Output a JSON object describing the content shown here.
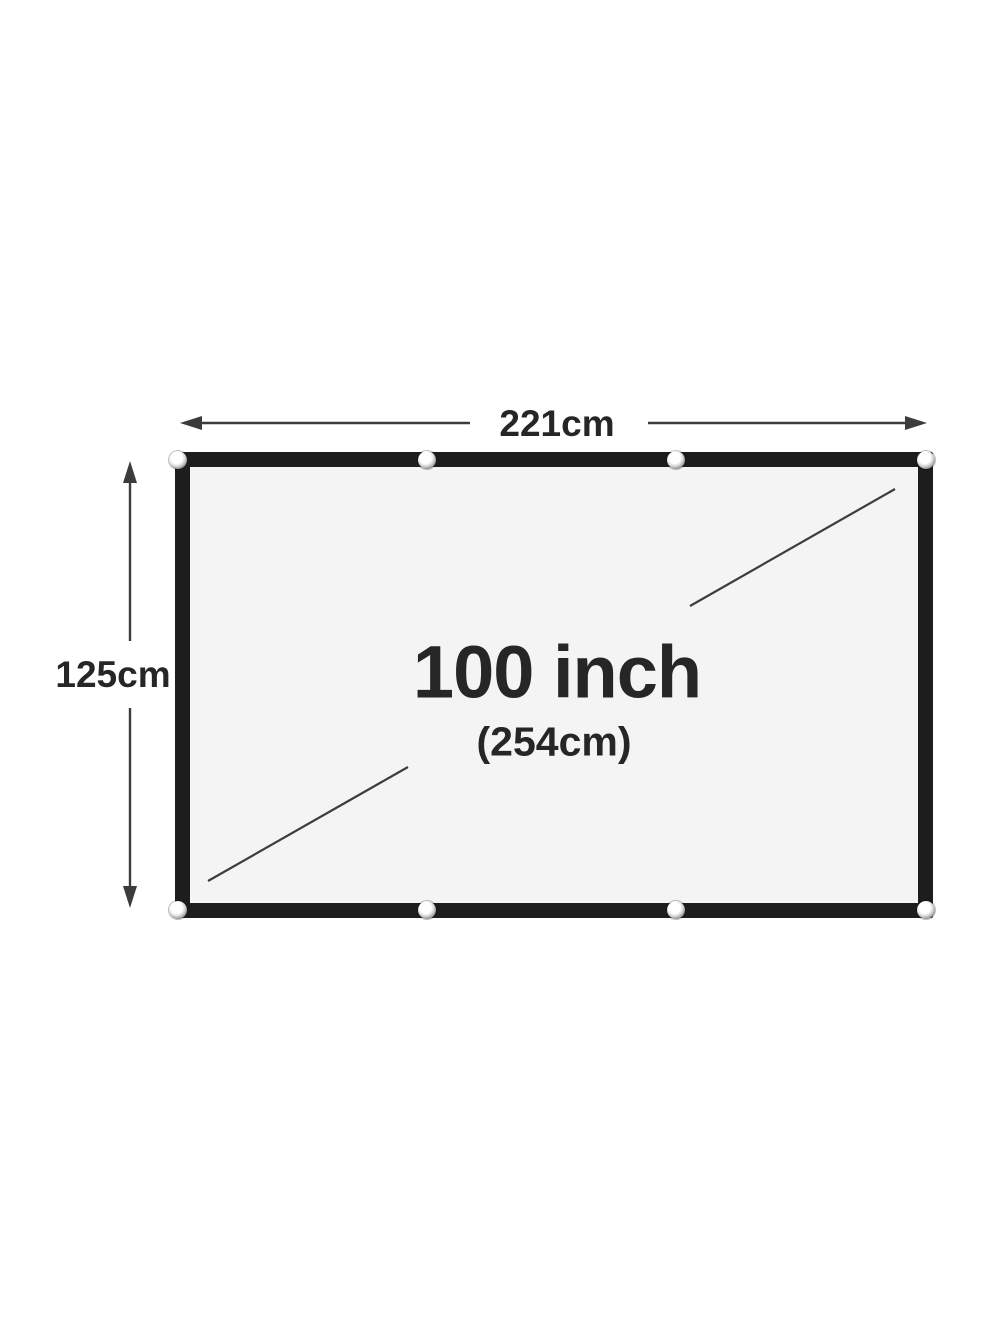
{
  "diagram": {
    "width_label": "221cm",
    "height_label": "125cm",
    "diagonal_label": "100 inch",
    "diagonal_sub_label": "(254cm)",
    "grommets": {
      "top_count": 4,
      "bottom_count": 4
    },
    "colors": {
      "background": "#ffffff",
      "screen_surface": "#f4f4f4",
      "screen_border": "#1d1d1d",
      "text": "#262626",
      "line": "#3c3c3c"
    }
  }
}
